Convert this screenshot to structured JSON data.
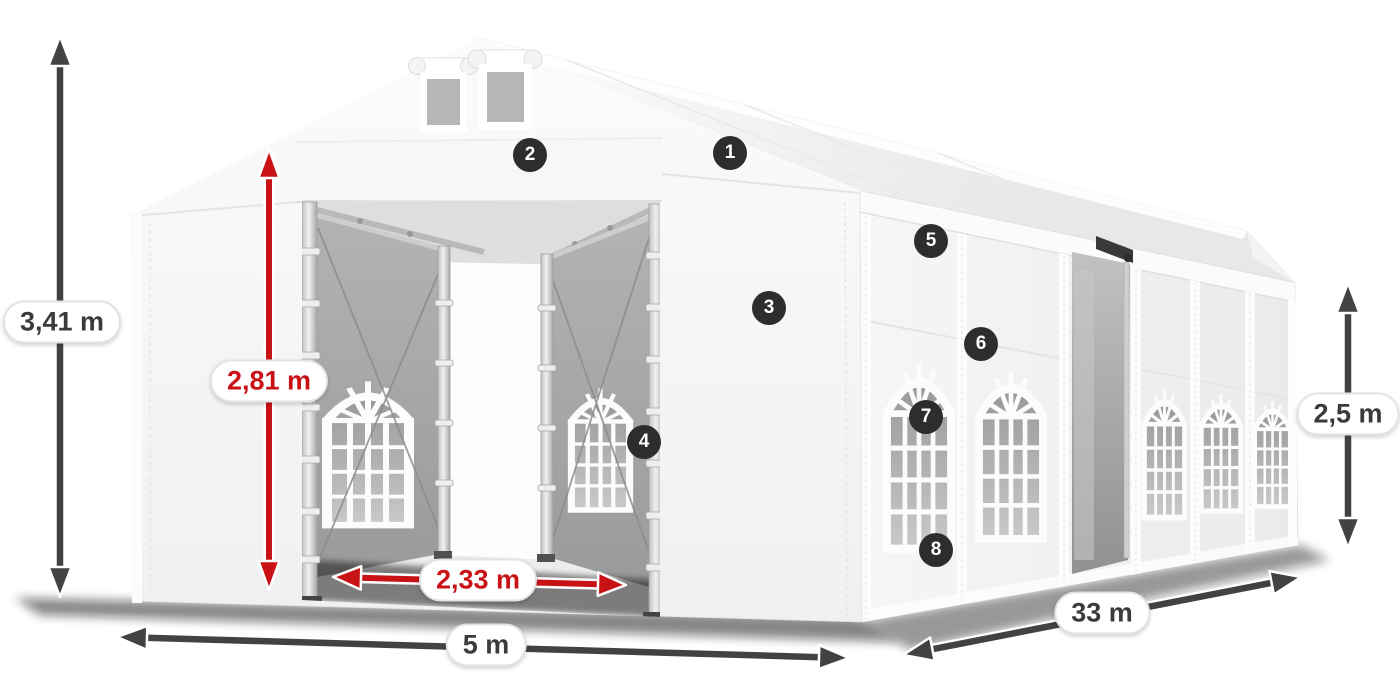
{
  "colors": {
    "background": "#ffffff",
    "dimension-dark": "#424245",
    "dimension-red": "#c81215",
    "label-text": "#3b3b3e",
    "label-bg": "#ffffff",
    "label-border": "#e3e3e3",
    "badge-bg": "#2d2d2f",
    "badge-text": "#ffffff",
    "tent-fabric": "#f7f7f8",
    "mesh-panel": "#a6a6a8"
  },
  "dimensions": {
    "total_height": {
      "label": "3,41 m"
    },
    "door_height": {
      "label": "2,81 m"
    },
    "door_width": {
      "label": "2,33 m"
    },
    "front_width": {
      "label": "5 m"
    },
    "side_length": {
      "label": "33 m"
    },
    "side_height": {
      "label": "2,5 m"
    }
  },
  "callouts": [
    {
      "number": "1"
    },
    {
      "number": "2"
    },
    {
      "number": "3"
    },
    {
      "number": "4"
    },
    {
      "number": "5"
    },
    {
      "number": "6"
    },
    {
      "number": "7"
    },
    {
      "number": "8"
    }
  ]
}
